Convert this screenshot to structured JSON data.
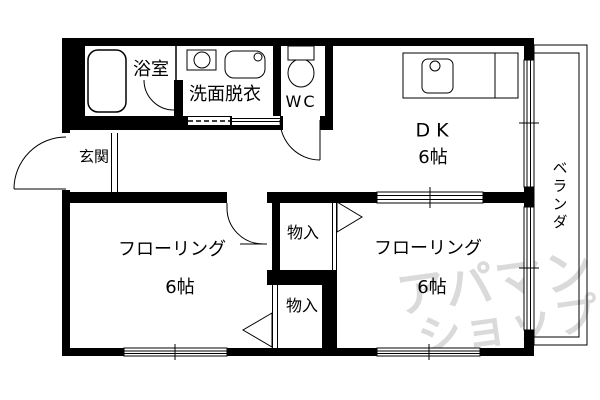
{
  "colors": {
    "wall": "#000000",
    "line": "#000000",
    "watermark": "#dadada"
  },
  "floorplan": {
    "rooms": {
      "bath": {
        "label": "浴室"
      },
      "washroom": {
        "label": "洗面脱衣"
      },
      "toilet": {
        "label": "WC"
      },
      "dining_kitchen": {
        "label": "DK",
        "size": "6帖"
      },
      "entrance": {
        "label": "玄関"
      },
      "flooring_left": {
        "label": "フローリング",
        "size": "6帖"
      },
      "flooring_right": {
        "label": "フローリング",
        "size": "6帖"
      },
      "closet_upper": {
        "label": "物入"
      },
      "closet_lower": {
        "label": "物入"
      },
      "balcony": {
        "label": "ベランダ"
      }
    },
    "fixtures": [
      "bathtub",
      "washing-machine",
      "wash-basin",
      "toilet",
      "kitchen-counter",
      "kitchen-sink"
    ]
  },
  "watermark": {
    "line1": "アパマン",
    "line2": "ショップ"
  }
}
